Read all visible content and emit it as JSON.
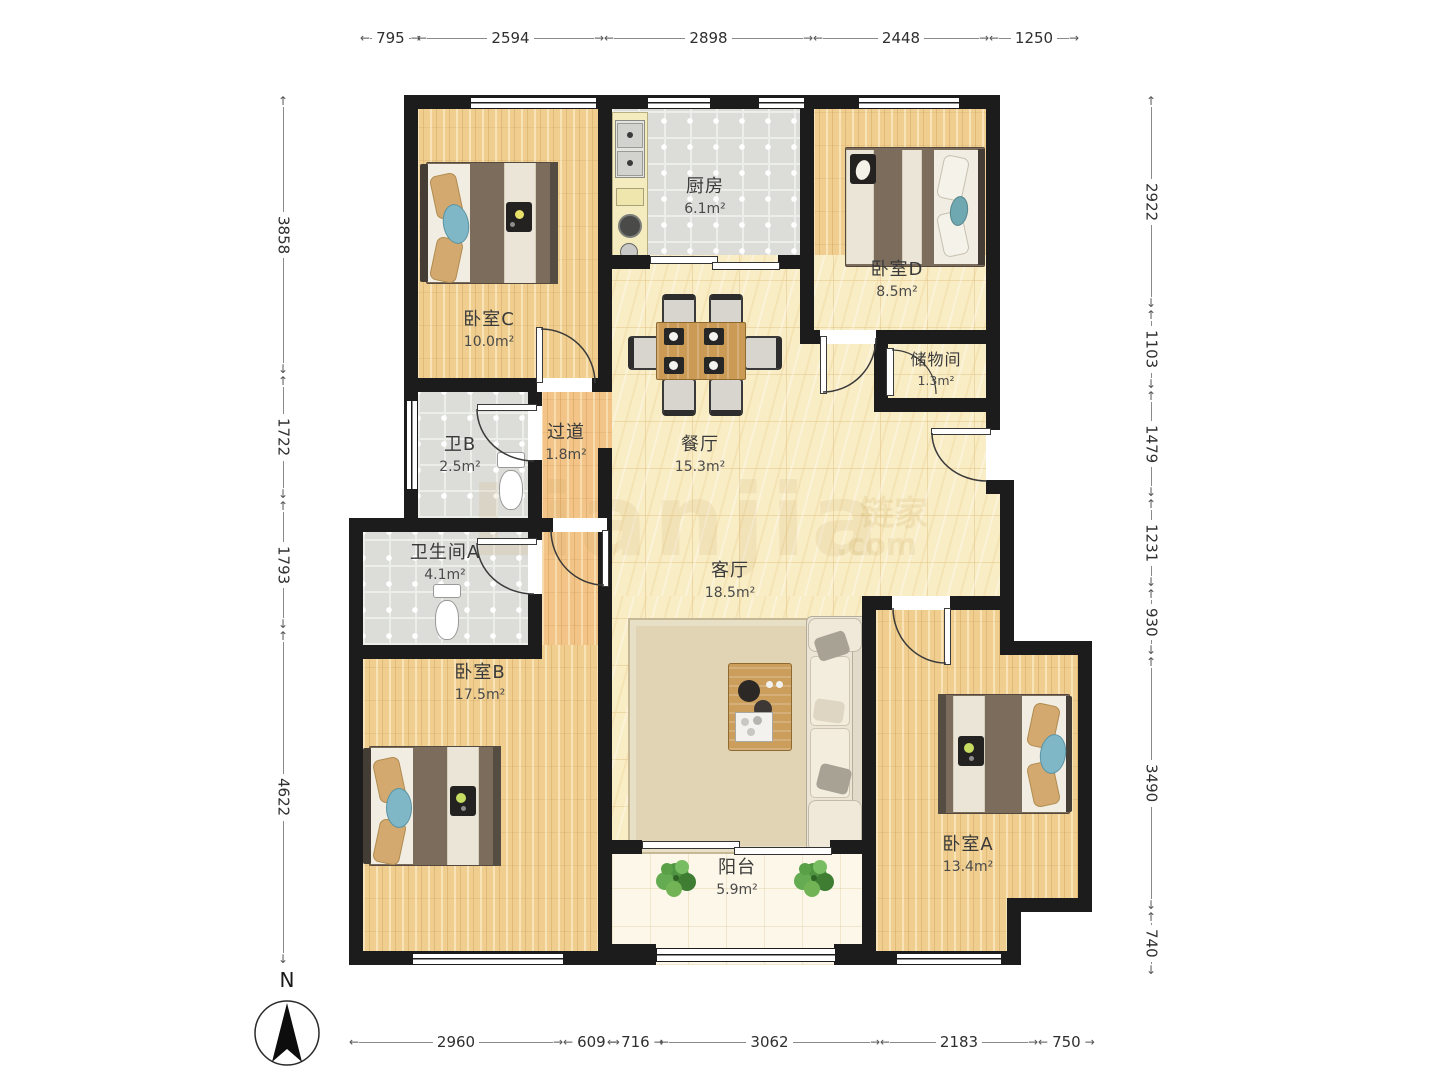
{
  "rooms": [
    {
      "id": "bedroom-c",
      "name": "卧室C",
      "area": "10.0m²"
    },
    {
      "id": "kitchen",
      "name": "厨房",
      "area": "6.1m²"
    },
    {
      "id": "bedroom-d",
      "name": "卧室D",
      "area": "8.5m²"
    },
    {
      "id": "storage",
      "name": "储物间",
      "area": "1.3m²"
    },
    {
      "id": "bath-b",
      "name": "卫B",
      "area": "2.5m²"
    },
    {
      "id": "hallway",
      "name": "过道",
      "area": "1.8m²"
    },
    {
      "id": "dining",
      "name": "餐厅",
      "area": "15.3m²"
    },
    {
      "id": "bath-a",
      "name": "卫生间A",
      "area": "4.1m²"
    },
    {
      "id": "living",
      "name": "客厅",
      "area": "18.5m²"
    },
    {
      "id": "bedroom-b",
      "name": "卧室B",
      "area": "17.5m²"
    },
    {
      "id": "balcony",
      "name": "阳台",
      "area": "5.9m²"
    },
    {
      "id": "bedroom-a",
      "name": "卧室A",
      "area": "13.4m²"
    }
  ],
  "dimensions": {
    "top": [
      "795",
      "2594",
      "2898",
      "2448",
      "1250"
    ],
    "left": [
      "3858",
      "1722",
      "1793",
      "4622"
    ],
    "right": [
      "2922",
      "1103",
      "1479",
      "1231",
      "930",
      "3490",
      "740"
    ],
    "bottom": [
      "2960",
      "609",
      "716",
      "3062",
      "2183",
      "750"
    ]
  },
  "compass": {
    "label": "N"
  },
  "watermark": {
    "main": "Lianjia",
    "cn": "链家",
    "suffix": ".com"
  },
  "colors": {
    "wall": "#1c1c1c",
    "wood": "#efce8f",
    "tile": "#dcdcd8",
    "marble": "#f9edc6",
    "accent_blue": "#7fb7c6"
  }
}
